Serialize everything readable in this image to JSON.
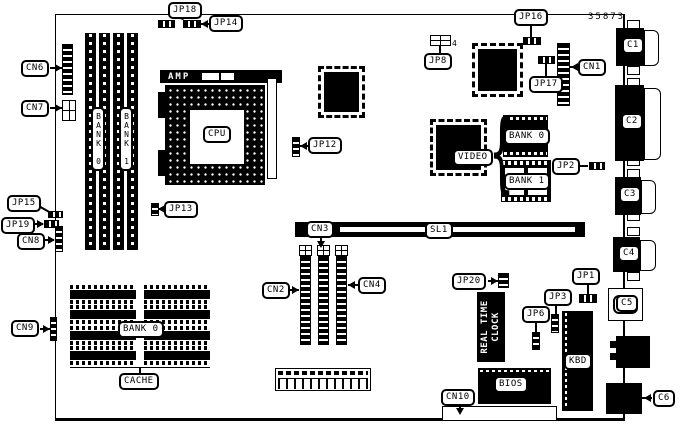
{
  "part_number": "35873",
  "colors": {
    "ink": "#000000",
    "paper": "#ffffff"
  },
  "jumpers": {
    "jp1": "JP1",
    "jp2": "JP2",
    "jp3": "JP3",
    "jp6": "JP6",
    "jp8": "JP8",
    "jp8_pin": "4",
    "jp12": "JP12",
    "jp13": "JP13",
    "jp14": "JP14",
    "jp15": "JP15",
    "jp16": "JP16",
    "jp17": "JP17",
    "jp18": "JP18",
    "jp19": "JP19",
    "jp20": "JP20"
  },
  "connectors": {
    "cn1": "CN1",
    "cn2": "CN2",
    "cn3": "CN3",
    "cn4": "CN4",
    "cn6": "CN6",
    "cn7": "CN7",
    "cn8": "CN8",
    "cn9": "CN9",
    "cn10": "CN10",
    "c1": "C1",
    "c2": "C2",
    "c3": "C3",
    "c4": "C4",
    "c5": "C5",
    "c6": "C6",
    "sl1": "SL1"
  },
  "components": {
    "cpu": "CPU",
    "cpu_socket_brand": "AMP",
    "video": "VIDEO",
    "video_bank0": "BANK 0",
    "video_bank1": "BANK 1",
    "simm_bank0": "BANK 0",
    "simm_bank1": "BANK 1",
    "cache_bank0": "BANK 0",
    "cache": "CACHE",
    "bios": "BIOS",
    "kbd": "KBD",
    "rtc_line1": "REAL TIME",
    "rtc_line2": "CLOCK"
  }
}
